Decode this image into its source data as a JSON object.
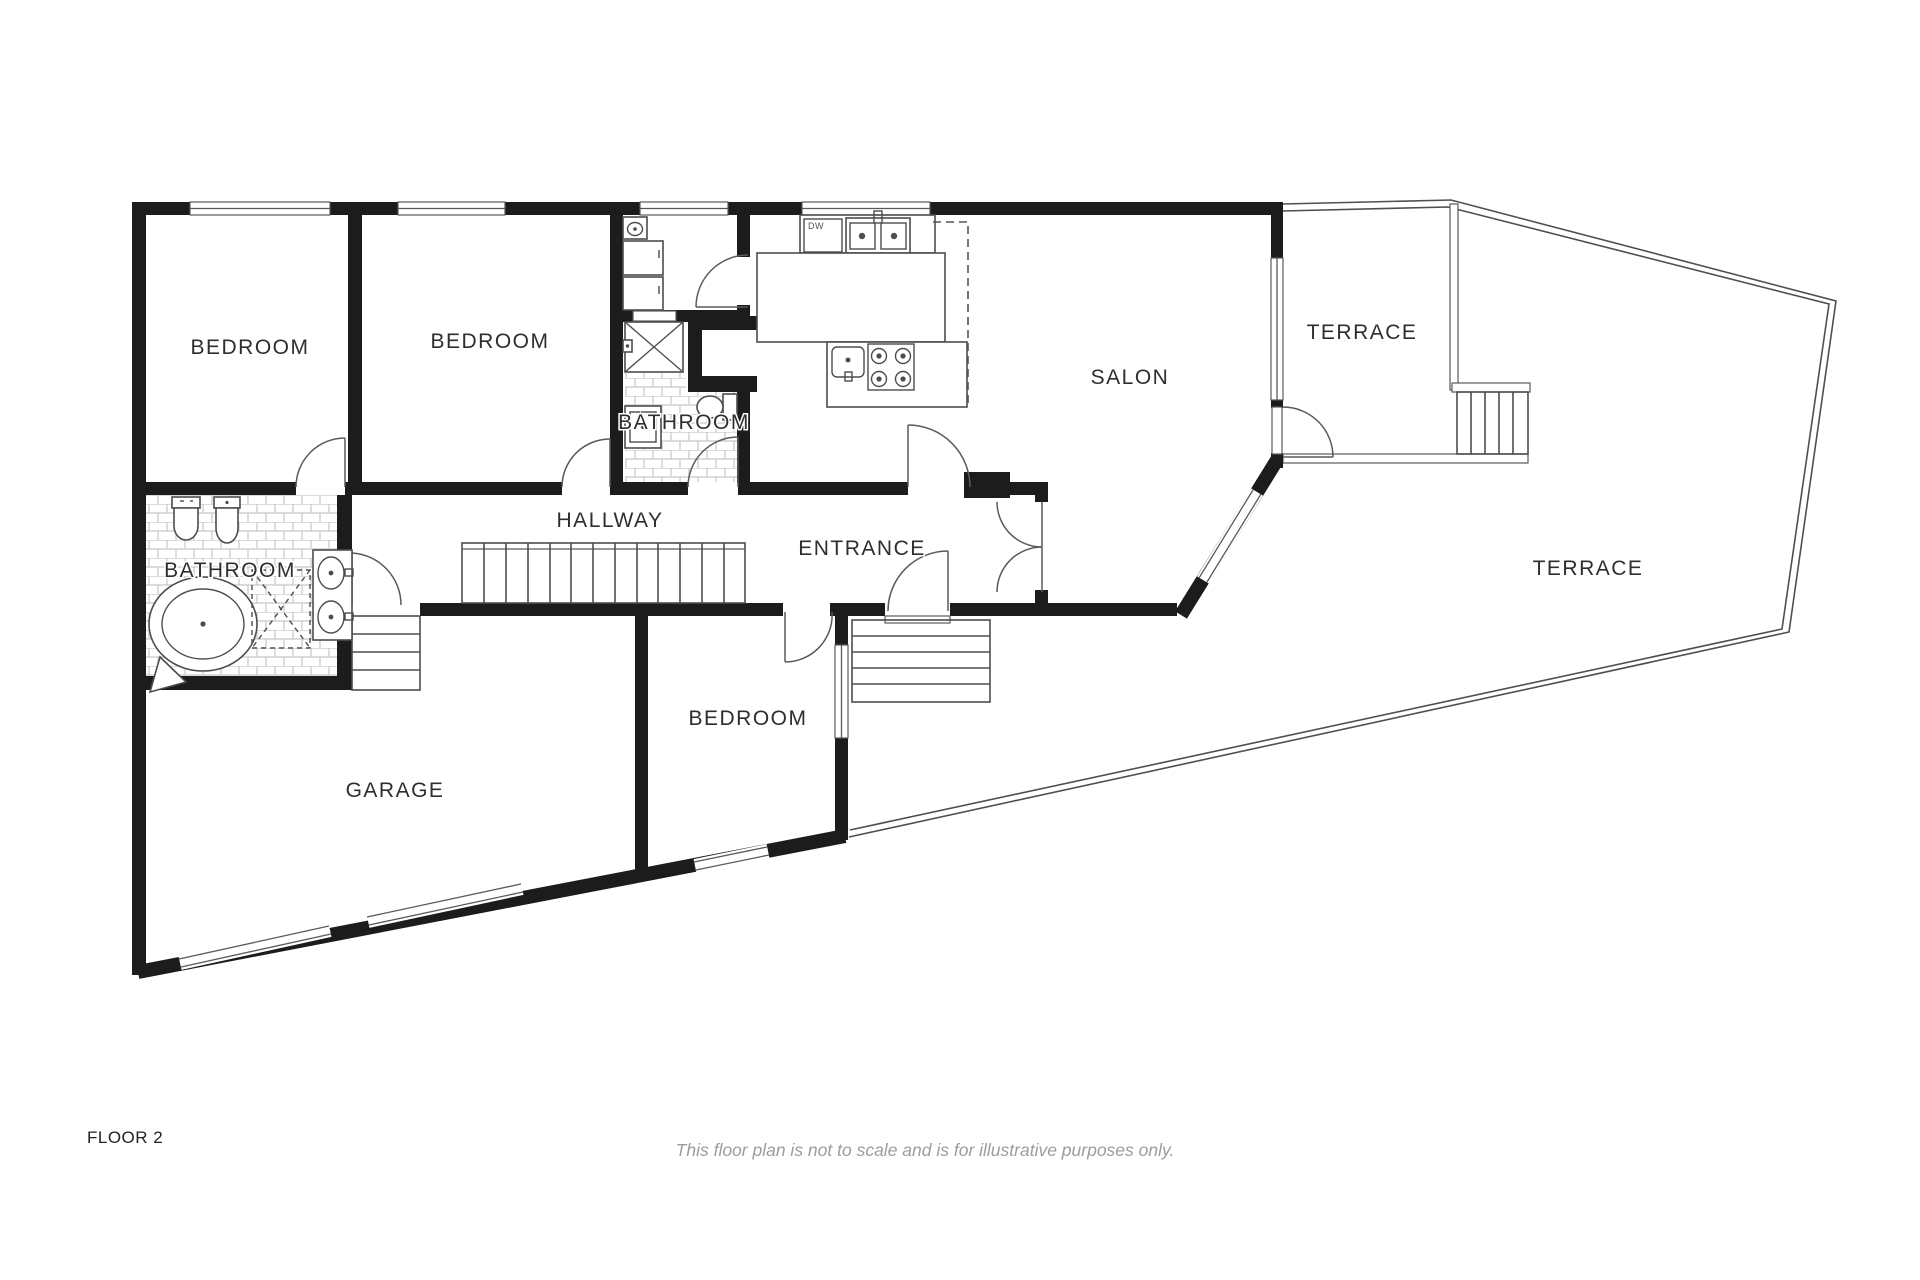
{
  "plan": {
    "rooms": {
      "bedroom1": {
        "label": "BEDROOM"
      },
      "bedroom2": {
        "label": "BEDROOM"
      },
      "bedroom3": {
        "label": "BEDROOM"
      },
      "bathroom_center": {
        "label": "BATHROOM"
      },
      "bathroom_left": {
        "label": "BATHROOM"
      },
      "hallway": {
        "label": "HALLWAY"
      },
      "entrance": {
        "label": "ENTRANCE"
      },
      "salon": {
        "label": "SALON"
      },
      "terrace_upper": {
        "label": "TERRACE"
      },
      "terrace_main": {
        "label": "TERRACE"
      },
      "garage": {
        "label": "GARAGE"
      }
    },
    "kitchen": {
      "dishwasher_label": "DW"
    }
  },
  "footer": {
    "floor_label": "FLOOR 2",
    "disclaimer": "This floor plan is not to scale and is for illustrative purposes only."
  },
  "colors": {
    "wall": "#1c1c1c",
    "line": "#4d4d4d",
    "tile": "#c6c6c6",
    "label": "#2e2e2e",
    "muted": "#9c9c9c"
  }
}
